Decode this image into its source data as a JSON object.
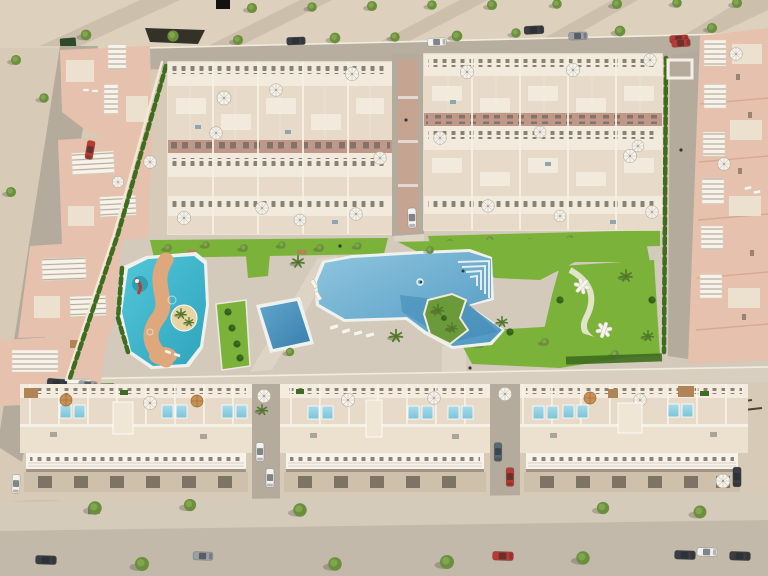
{
  "meta": {
    "domain": "natural-image",
    "description": "Aerial 3D architectural render of a new-build residential development: two dense townhouse blocks at the top, detached villas along a diagonal street on the left, terraced houses on the right, a central communal garden with a large lagoon pool, a children's splash pool with slide, a lap pool and a calisthenics park, and a row of three apartment buildings with rooftop plunge pools along the bottom access road.",
    "no_visible_text": true
  },
  "palette": {
    "sand": "#d7cab7",
    "desert": "#ddd1be",
    "roadTop": "#b7aea0",
    "road": "#c2b9ab",
    "street": "#b4ab9d",
    "paving": "#d3cabb",
    "pavingLight": "#ddd4c5",
    "promen": "#d8cfc0",
    "lane": "#c0988a",
    "block": "#e0d4c2",
    "roofWhite": "#f2ebdd",
    "terrace": "#e7dac8",
    "cream": "#ece1cf",
    "louver": "#f7f3ea",
    "grass": "#7ab23a",
    "grassDark": "#5d9427",
    "hedge": "#3f6d1f",
    "bush": "#35601d",
    "tree": "#6b8f3e",
    "treeLight": "#84a84f",
    "palm": "#4f7d2a",
    "poolRim": "#eff1ee",
    "lagoonA": "#8fc6de",
    "lagoonB": "#4f97c2",
    "lagoonDeep": "#3f88b4",
    "kidsA": "#53c6d8",
    "kidsB": "#2ea4bd",
    "lapA": "#5fa6cc",
    "lapB": "#3a7fae",
    "rooftopPoolA": "#a8dcea",
    "rooftopPoolB": "#7cc3d8",
    "sandPath": "#dfa87c",
    "islandSand": "#e7d5a6",
    "pink": "#e6c1ad",
    "pinkLine": "#d8a992",
    "wood": "#b08454",
    "tan": "#c79054",
    "umb": "#f6f3ec",
    "carWhite": "#f2f2f0",
    "carRed": "#b93a30",
    "carDark": "#3a3d42",
    "carGray": "#9aa0a4",
    "carBlue": "#5b6874",
    "binGreen": "#2f4a28",
    "slit": "#6e675c",
    "shadow": "rgba(74,66,54,0.16)"
  },
  "scene": {
    "areas": {
      "top": "unpaved desert strip and access road with street trees and parked cars",
      "left": "diagonal street with four villa clusters, white pergola roofs, parked cars",
      "center_top": "two townhouse blocks separated by a paved central street",
      "right": "terraced houses behind a hedge-lined private street with entrance gate",
      "center": "communal garden: lagoon pool with palm island and beach steps, kids splash pool with slide and winding sand path, lap pool, lawn planters, calisthenics park",
      "bottom": "three apartment buildings with rooftop terraces and plunge pools, side parking streets, sidewalk and main road with parked cars"
    },
    "counts": {
      "townhouse_blocks": 2,
      "apartment_buildings": 3,
      "villa_clusters": 4,
      "communal_pools": 3,
      "rooftop_plunge_pools": 18,
      "parasols": 31,
      "parked_cars": 23,
      "trees_and_palms": 60,
      "exercise_frames": 2,
      "benches": 3,
      "water_slide": 1,
      "palm_islands": 2
    }
  }
}
